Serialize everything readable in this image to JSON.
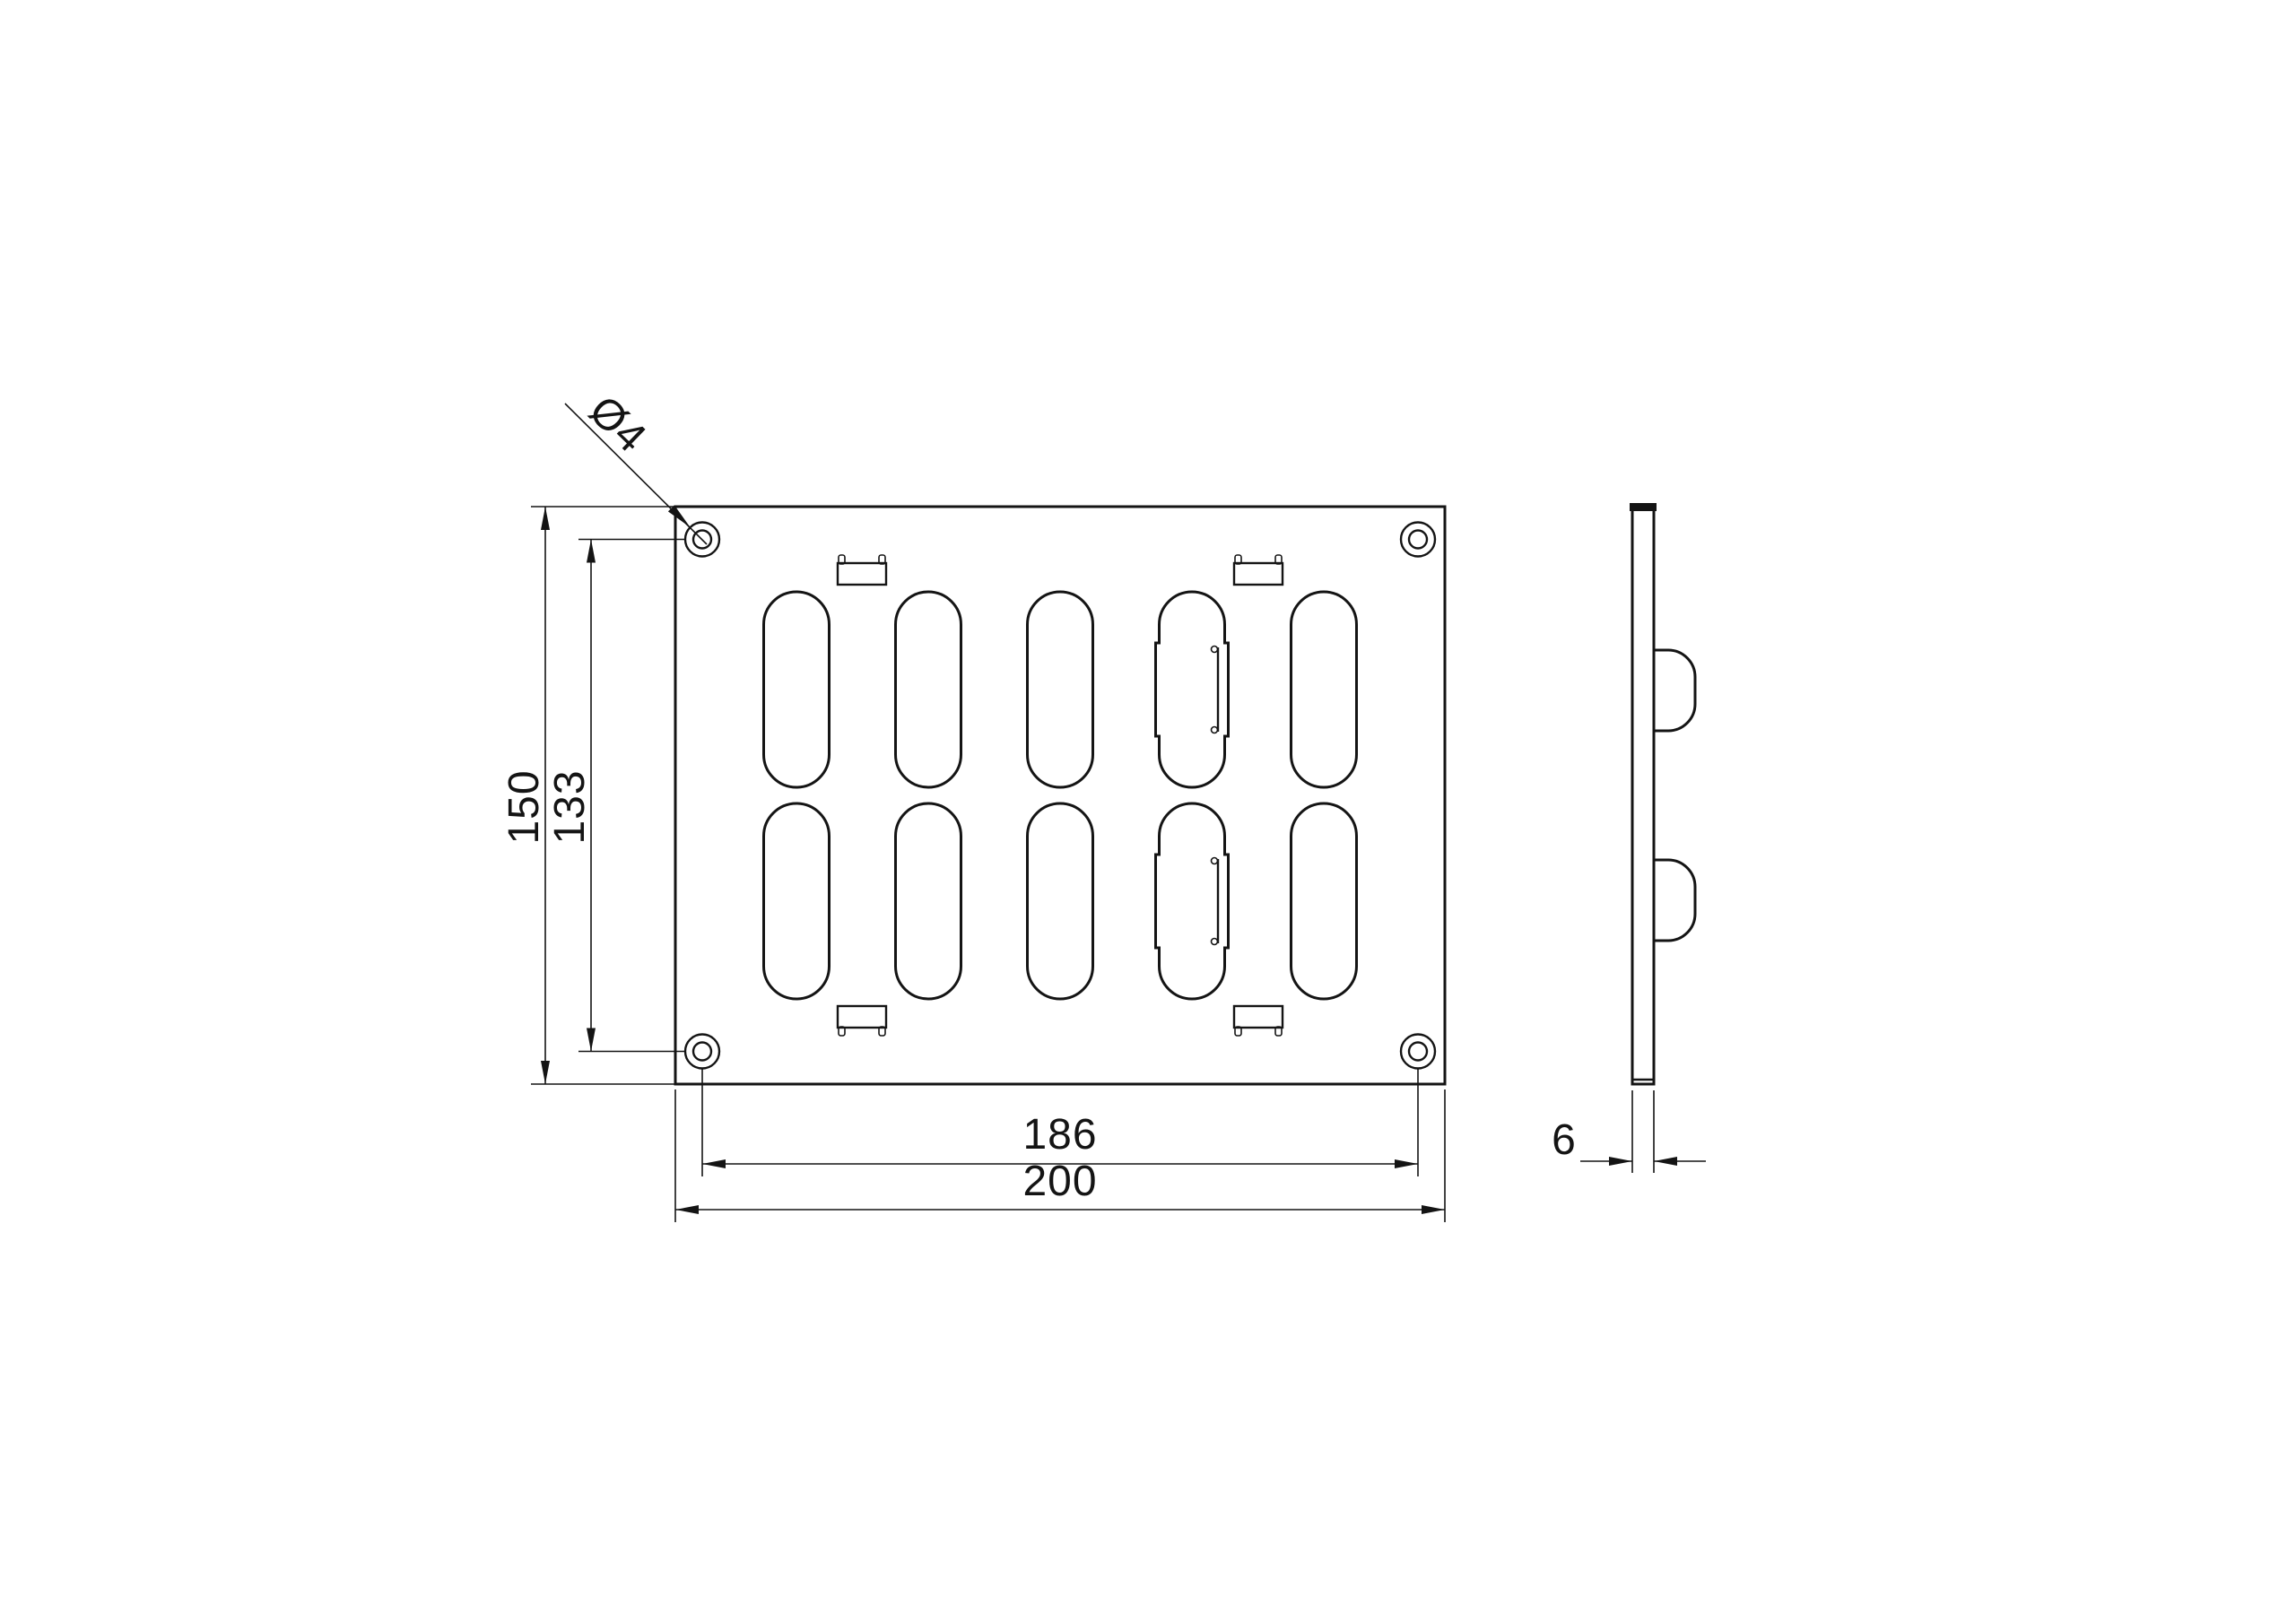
{
  "drawing": {
    "description": "Two-view technical drawing of a slotted ventilation grille plate",
    "colors": {
      "line": "#141414",
      "background": "#ffffff"
    },
    "dimensions": {
      "overall_height": "150",
      "hole_pitch_vertical": "133",
      "hole_pitch_horizontal": "186",
      "overall_width": "200",
      "thickness": "6",
      "hole_diameter": "Ø4"
    }
  }
}
